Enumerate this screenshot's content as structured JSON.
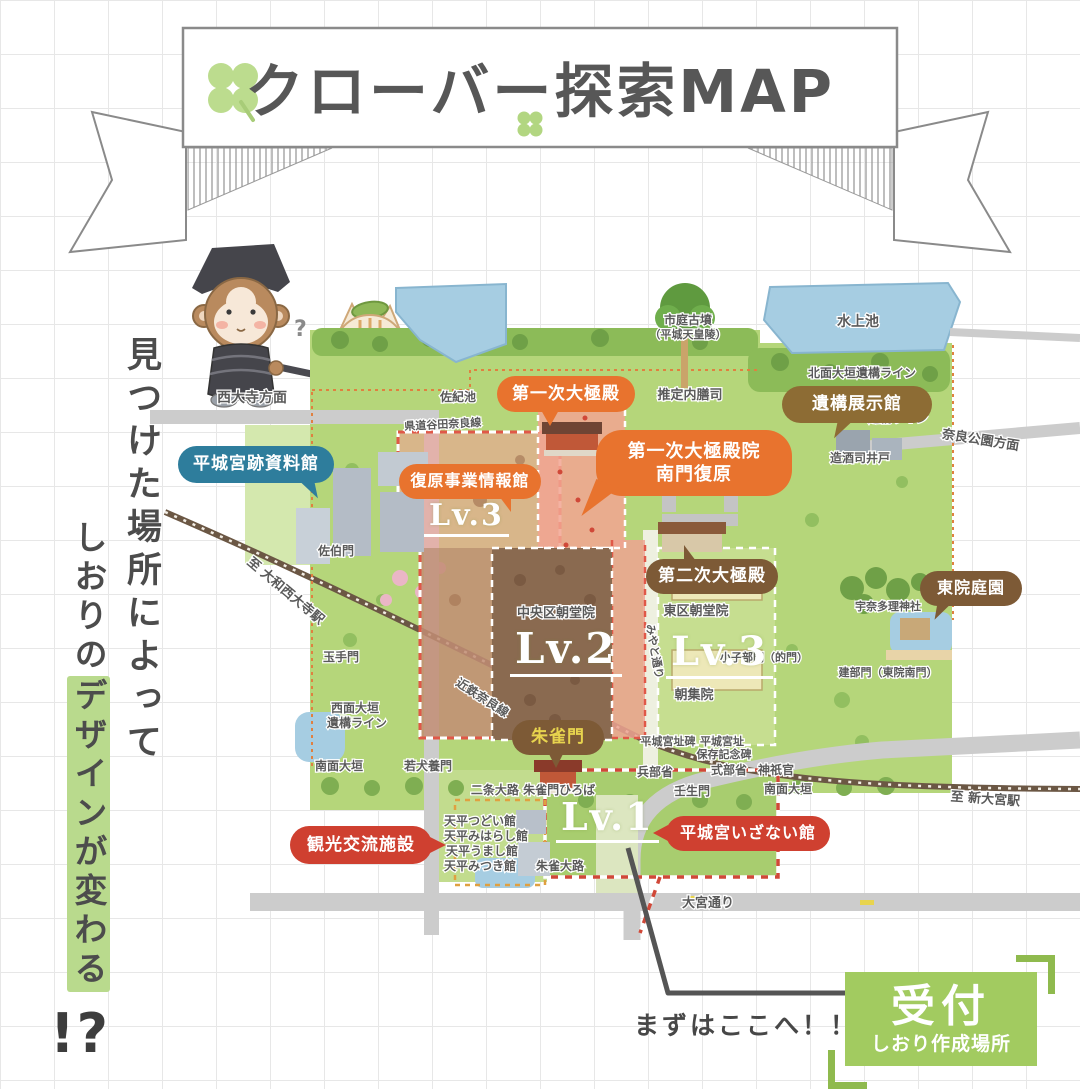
{
  "title": "クローバー探索MAP",
  "tagline": {
    "line1": "見つけた場所によって",
    "line2_prefix": "しおりの",
    "line2_highlight": "デザインが変わる",
    "line2_punct": "!?"
  },
  "colors": {
    "accent_orange": "#e8732e",
    "accent_brown": "#7d5a36",
    "accent_olive_brown": "#8d6c34",
    "accent_teal": "#2e7d9c",
    "accent_red": "#cf4030",
    "reception_green": "#a2cb60",
    "highlight_green": "#b9da8d",
    "suzakumon_text": "#e8d44e"
  },
  "callouts": {
    "daigokuden1": "第一次大極殿",
    "nanmon_line1": "第一次大極殿院",
    "nanmon_line2": "南門復原",
    "ikou_tenjikan": "遺構展示館",
    "shiryokan": "平城宮跡資料館",
    "fukugen_joho": "復原事業情報館",
    "daigokuden2": "第二次大極殿",
    "toin_teien": "東院庭園",
    "suzakumon": "朱雀門",
    "kanko": "観光交流施設",
    "izanai": "平城宮いざない館"
  },
  "levels": {
    "nw": "Lv.3",
    "center": "Lv.2",
    "east": "Lv.3",
    "south": "Lv.1"
  },
  "map_labels": {
    "saidaiji_homen": "西大寺方面",
    "kendo": "県道谷田奈良線",
    "sakiike": "佐紀池",
    "ichiniwa_kofun": "市庭古墳",
    "heijo_tennoryo": "（平城天皇陵）",
    "suitei_naizenshi": "推定内膳司",
    "mizugami_ike": "水上池",
    "hokumen_line": "北面大垣遺構ライン",
    "tomen_1": "東面大垣",
    "tomen_2": "遺構ライン",
    "nara_koen": "奈良公園方面",
    "mikinotsukasa_ido": "造酒司井戸",
    "suitei_kunaisho": "推定宮内省",
    "saeki_mon": "佐伯門",
    "yamato_saidaiji": "至 大和西大寺駅",
    "chuoku_chodoin": "中央区朝堂院",
    "higashiku_chodoin": "東区朝堂院",
    "choshuin": "朝集院",
    "chiisakobe_mon": "小子部門（的門）",
    "miyato_dori": "みやと通り",
    "kintetsu_nara": "近鉄奈良線",
    "tamate_mon": "玉手門",
    "seimen_1": "西面大垣",
    "seimen_2": "遺構ライン",
    "nanmen_west": "南面大垣",
    "wakainukai_mon": "若犬養門",
    "nijo_oji": "二条大路 朱雀門ひろば",
    "tsudoi": "天平つどい館",
    "miharashi": "天平みはらし館",
    "umashi": "天平うまし館",
    "mitsuki": "天平みつき館",
    "suzaku_oji": "朱雀大路",
    "hyobusho": "兵部省",
    "shikibusho": "式部省",
    "jingikan": "神祇官",
    "mibu_mon": "壬生門",
    "nanmen_east": "南面大垣",
    "shisekihi": "平城宮址碑",
    "shiseki2": "平城宮址",
    "hozon_kinenhi": "保存記念碑",
    "unatari_jinja": "宇奈多理神社",
    "tatebe_mon": "建部門（東院南門）",
    "shin_omiya": "至 新大宮駅",
    "omiya_dori": "大宮通り"
  },
  "reception": {
    "note": "まずはここへ！！",
    "title": "受付",
    "subtitle": "しおり作成場所"
  }
}
